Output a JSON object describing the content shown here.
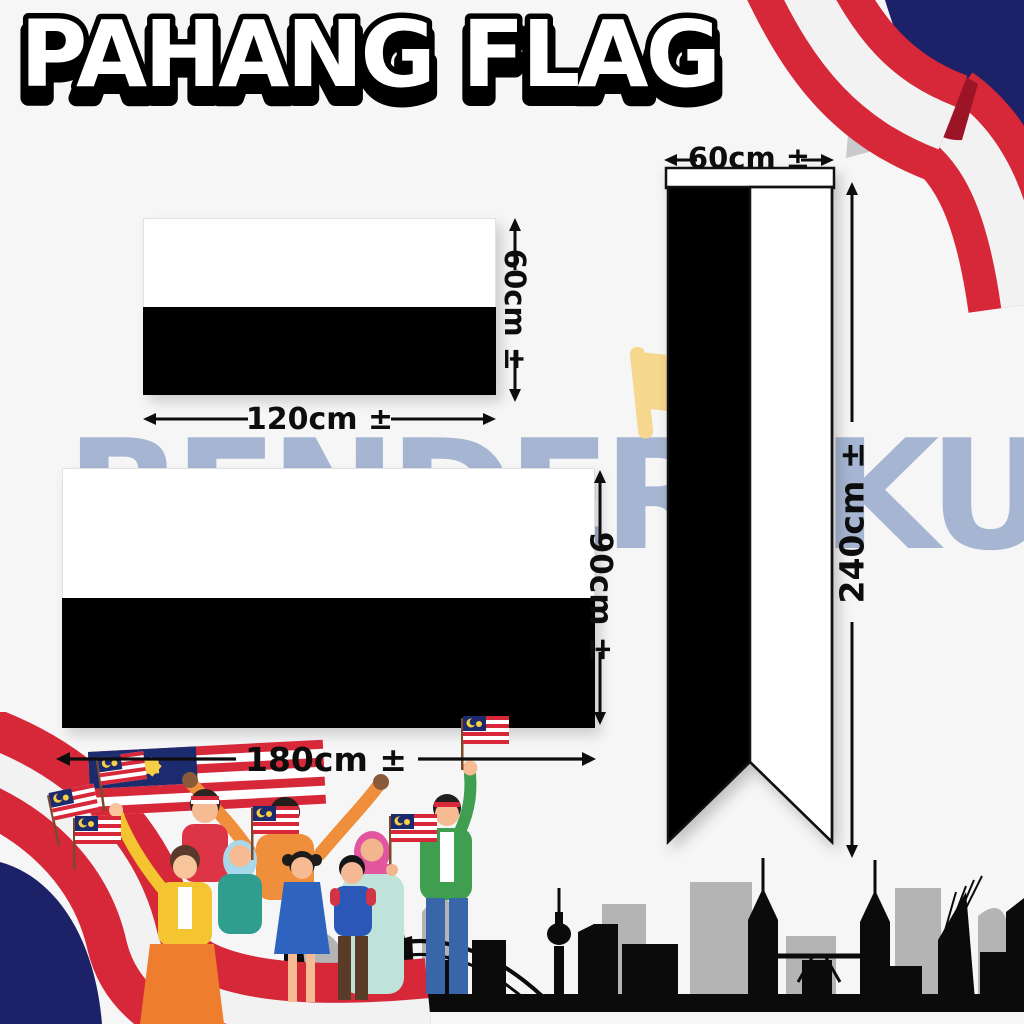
{
  "title": "PAHANG FLAG",
  "watermark": {
    "text": "BENDERAKU",
    "color": "#a6b6d2"
  },
  "background_color": "#f6f6f7",
  "flags": {
    "small_horizontal": {
      "top_color": "#ffffff",
      "bottom_color": "#000000",
      "width_label": "120cm ±",
      "height_label": "60cm ±"
    },
    "large_horizontal": {
      "top_color": "#ffffff",
      "bottom_color": "#000000",
      "width_label": "180cm ±",
      "height_label": "90cm ±"
    },
    "vertical_pennant": {
      "left_color": "#000000",
      "right_color": "#ffffff",
      "header_color": "#ffffff",
      "width_label": "60cm ±",
      "height_label": "240cm ±"
    }
  },
  "decorations": {
    "top_right_ribbon": {
      "icon": "malaysia-ribbon-icon",
      "navy": "#1d2168",
      "red": "#d62839",
      "white": "#f2f2f2"
    },
    "bottom_left_crowd": {
      "icon": "malaysian-people-crowd-icon",
      "held_flag": "malaysia-flag-icon"
    },
    "skyline": {
      "icon": "kuala-lumpur-skyline-icon",
      "front": "#0b0b0b",
      "back": "#b4b4b4"
    },
    "watermark_flag": {
      "icon": "yellow-flag-icon",
      "color": "#f5d78e"
    }
  }
}
